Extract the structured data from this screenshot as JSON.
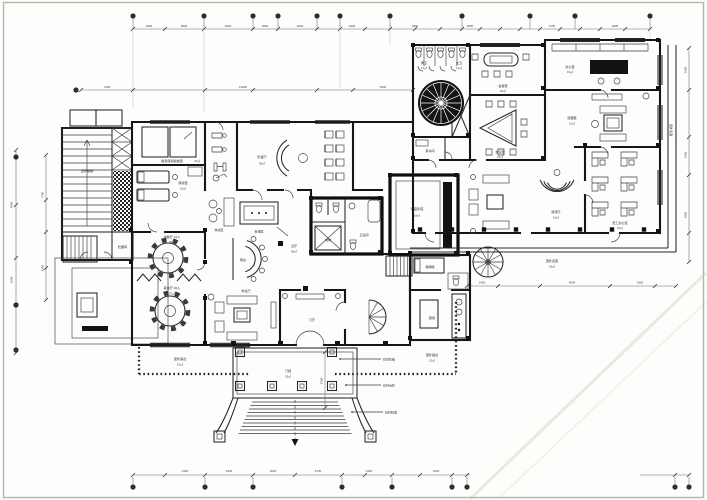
{
  "drawing": {
    "rooms": {
      "outdoor_stair": {
        "name": "室外楼梯"
      },
      "storage": {
        "name": "贮藏间"
      },
      "gym": {
        "name": "健身房和瑜伽室",
        "area": "47㎡"
      },
      "massage": {
        "name": "按摩室",
        "area": "19㎡"
      },
      "av_hall": {
        "name": "影音厅",
        "area": "36㎡"
      },
      "lounge_small": {
        "name": "休息区"
      },
      "billiard": {
        "name": "台球区"
      },
      "bar": {
        "name": "吧台"
      },
      "dining_small": {
        "name": "中餐厅 12人",
        "area": "39㎡"
      },
      "banquet": {
        "name": "宴会厅 40人",
        "area": "75㎡"
      },
      "lounge_main": {
        "name": "休息厅"
      },
      "foyer": {
        "name": "过厅",
        "area": "45㎡"
      },
      "vestibule": {
        "name": "门厅"
      },
      "porch": {
        "name": "门廊",
        "area": "25㎡"
      },
      "home_theater": {
        "name": "家庭影院",
        "area": "18㎡"
      },
      "wc_core": {
        "name": "卫生间"
      },
      "elevator": {
        "name": "电梯"
      },
      "nanny": {
        "name": "保姆房"
      },
      "kitchen": {
        "name": "厨房"
      },
      "mens": {
        "name": "男卫",
        "area": "11㎡"
      },
      "womens": {
        "name": "女卫",
        "area": "11㎡"
      },
      "parlor": {
        "name": "会客室",
        "area": "20㎡"
      },
      "meeting": {
        "name": "会议室",
        "area": "15㎡"
      },
      "pantry": {
        "name": "茶水间"
      },
      "office": {
        "name": "办公室",
        "area": "15㎡"
      },
      "manager": {
        "name": "经理室",
        "area": "21㎡"
      },
      "staff": {
        "name": "员工办公区",
        "area": "24㎡"
      },
      "reception": {
        "name": "接待厅",
        "area": "19㎡"
      },
      "terrace_w": {
        "name": "室外露台",
        "area": "15㎡"
      },
      "terrace_e": {
        "name": "室外露台",
        "area": "21㎡"
      },
      "walkway_s": {
        "name": "室外走廊",
        "area": "63㎡"
      },
      "walkway_e": {
        "name": "室外走廊"
      }
    },
    "annotations": {
      "rail": "石材栏板",
      "step": "石材台阶",
      "plinth": "石材柱墩"
    },
    "dims": {
      "top": [
        "3300",
        "3900",
        "2400",
        "2600",
        "2200",
        "2300",
        "2800",
        "2500",
        "2100",
        "2600"
      ],
      "upper": [
        "7400",
        "12600",
        "5200"
      ],
      "bottom": [
        "3300",
        "2400",
        "3000",
        "2700",
        "2400",
        "1500"
      ],
      "left_outer": [
        "9900",
        "6200"
      ],
      "left_inner": [
        "7700",
        "8100"
      ],
      "right": [
        "5400",
        "6600",
        "4800"
      ],
      "walkway": [
        "2400",
        "9000",
        "3300"
      ],
      "porch": [
        "4500"
      ]
    },
    "colors": {
      "paper": "#fdfdfc",
      "line": "#161616",
      "thin": "#3d3d3d",
      "dim": "#6a6a6a",
      "crease": "#ebe8e2",
      "frame": "#b5b3ae"
    }
  }
}
